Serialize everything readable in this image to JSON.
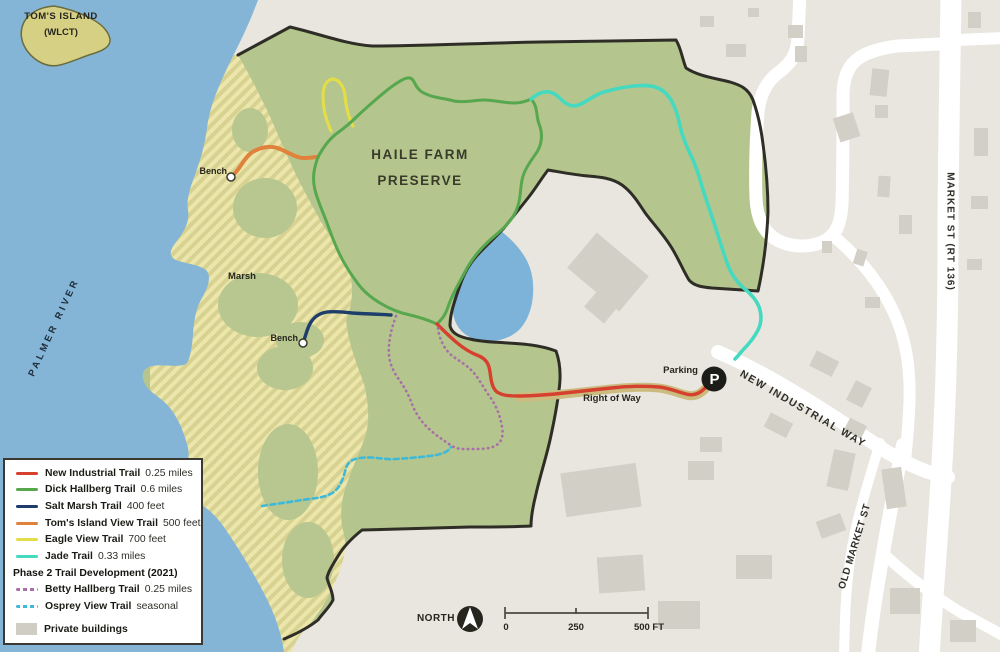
{
  "legend": {
    "rows": [
      {
        "name": "New Industrial Trail",
        "value": "0.25 miles"
      },
      {
        "name": "Dick Hallberg Trail",
        "value": "0.6 miles"
      },
      {
        "name": "Salt Marsh Trail",
        "value": "400 feet"
      },
      {
        "name": "Tom's Island View Trail",
        "value": "500 feet"
      },
      {
        "name": "Eagle View Trail",
        "value": "700 feet"
      },
      {
        "name": "Jade Trail",
        "value": "0.33 miles"
      }
    ],
    "phase2_header": "Phase 2 Trail Development (2021)",
    "phase2_rows": [
      {
        "name": "Betty Hallberg Trail",
        "value": "0.25 miles"
      },
      {
        "name": "Osprey View Trail",
        "value": "seasonal"
      }
    ],
    "private_buildings_label": "Private buildings"
  },
  "map_labels": {
    "island_line1": "TOM'S ISLAND",
    "island_line2": "(WLCT)",
    "river": "PALMER RIVER",
    "marsh": "Marsh",
    "preserve_line1": "HAILE FARM",
    "preserve_line2": "PRESERVE",
    "bench_north": "Bench",
    "bench_south": "Bench",
    "right_of_way": "Right of Way",
    "parking": "Parking",
    "parking_symbol": "P",
    "road_new_industrial": "NEW INDUSTRIAL WAY",
    "road_market": "MARKET ST (RT 136)",
    "road_old_market": "OLD MARKET ST"
  },
  "compass": {
    "label": "NORTH"
  },
  "scale_bar": {
    "tick_0": "0",
    "tick_mid": "250",
    "tick_end": "500 FT"
  },
  "colors": {
    "water": "#84b5d6",
    "preserve_green": "#b4c68d",
    "marsh_stripe": "#ece6ab",
    "land": "#e9e6e0",
    "road": "#ffffff",
    "building": "#d2cfc6",
    "boundary": "#2e2e26",
    "trail_new_industrial": "#d6402e",
    "trail_dick_hallberg": "#57a74e",
    "trail_salt_marsh": "#1d3d6b",
    "trail_toms_island_view": "#e0823c",
    "trail_eagle_view": "#e3dd4a",
    "trail_jade": "#45d9c0",
    "trail_betty_hallberg": "#a86fa8",
    "trail_osprey_view": "#3fb9d8",
    "right_of_way_casing": "#cbbb7e"
  }
}
